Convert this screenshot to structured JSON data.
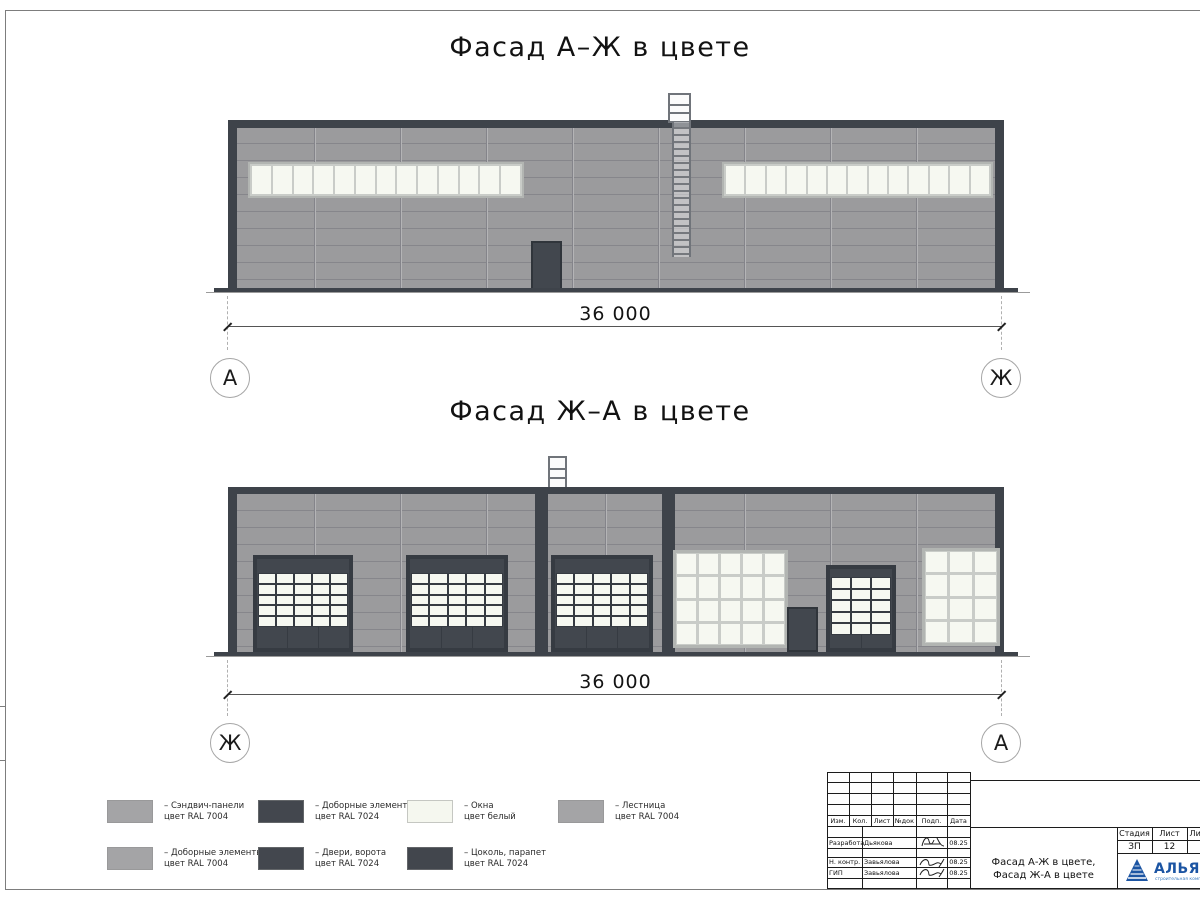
{
  "titles": {
    "facade_top": "Фасад А–Ж в цвете",
    "facade_bottom": "Фасад Ж–А в цвете"
  },
  "dimensions": {
    "top": "36 000",
    "bottom": "36 000"
  },
  "axes": {
    "letter_a": "А",
    "letter_zh": "Ж"
  },
  "colors": {
    "wall": "#9b9b9d",
    "panel_line": "#86868b",
    "dark": "#3e434a",
    "door": "#42474e",
    "window_pane": "#f6f8f1",
    "mullion": "#c9ccc8",
    "window_frame": "#b2b5b2",
    "base": "#3e434a",
    "logo_blue": "#1c55a3"
  },
  "legend": {
    "items": [
      {
        "color": "#a4a4a6",
        "line1": "– Сэндвич-панели",
        "line2": "цвет RAL 7004"
      },
      {
        "color": "#43474e",
        "line1": "– Доборные элементы",
        "line2": "цвет RAL 7024"
      },
      {
        "color": "#f5f7ef",
        "line1": "– Окна",
        "line2": "цвет белый"
      },
      {
        "color": "#a4a4a6",
        "line1": "– Лестница",
        "line2": "цвет RAL 7004"
      },
      {
        "color": "#a4a4a6",
        "line1": "– Доборные элементы",
        "line2": "цвет RAL 7004"
      },
      {
        "color": "#43474e",
        "line1": "– Двери, ворота",
        "line2": "цвет RAL 7024"
      },
      {
        "color": "#42464d",
        "line1": "– Цоколь, парапет",
        "line2": "цвет RAL 7024"
      }
    ]
  },
  "title_block": {
    "rev_headers": [
      "Изм.",
      "Кол.",
      "Лист",
      "№док",
      "Подп.",
      "Дата"
    ],
    "rows": [
      {
        "role": "Разработал",
        "name": "Дьякова",
        "date": "08.25"
      },
      {
        "role": "Н. контр.",
        "name": "Завьялова",
        "date": "08.25"
      },
      {
        "role": "ГИП",
        "name": "Завьялова",
        "date": "08.25"
      }
    ],
    "doc_title_line1": "Фасад А-Ж в цвете,",
    "doc_title_line2": "Фасад Ж-А в цвете",
    "stage_label": "Стадия",
    "sheet_label": "Лист",
    "sheets_label": "Листов",
    "stage_value": "ЗП",
    "sheet_value": "12",
    "sheets_value": "2",
    "logo_text": "АЛЬЯНС",
    "logo_tagline": "строительная компания"
  }
}
